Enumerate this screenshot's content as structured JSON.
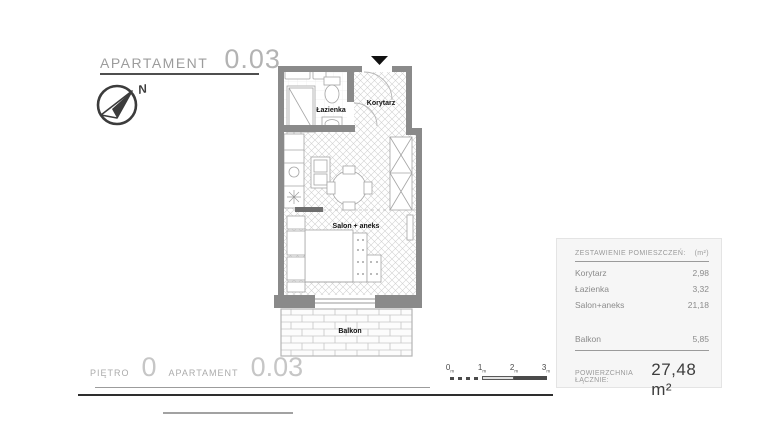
{
  "title": {
    "label": "APARTAMENT",
    "number": "0.03"
  },
  "compass": {
    "north_label": "N"
  },
  "plan": {
    "rooms": [
      {
        "name": "Łazienka"
      },
      {
        "name": "Korytarz"
      },
      {
        "name": "Salon + aneks"
      },
      {
        "name": "Balkon"
      }
    ]
  },
  "summary": {
    "header": "ZESTAWIENIE POMIESZCZEŃ:",
    "unit_header": "(m²)",
    "rows": [
      {
        "label": "Korytarz",
        "value": "2,98"
      },
      {
        "label": "Łazienka",
        "value": "3,32"
      },
      {
        "label": "Salon+aneks",
        "value": "21,18"
      }
    ],
    "balcony_row": {
      "label": "Balkon",
      "value": "5,85"
    },
    "total_label": "POWIERZCHNIA ŁĄCZNIE:",
    "total_value": "27,48 m²"
  },
  "footer": {
    "floor_label": "PIĘTRO",
    "floor_value": "0",
    "apartment_label": "APARTAMENT",
    "apartment_value": "0.03"
  },
  "scalebar": {
    "ticks": [
      "0",
      "1",
      "2",
      "3"
    ],
    "unit": "m"
  },
  "colors": {
    "wall": "#8a8a8a",
    "accent_dark": "#2e2e2e",
    "panel_bg": "#f6f6f6",
    "text_gray": "#8b8b8b",
    "light_text": "#c6c6c6"
  }
}
